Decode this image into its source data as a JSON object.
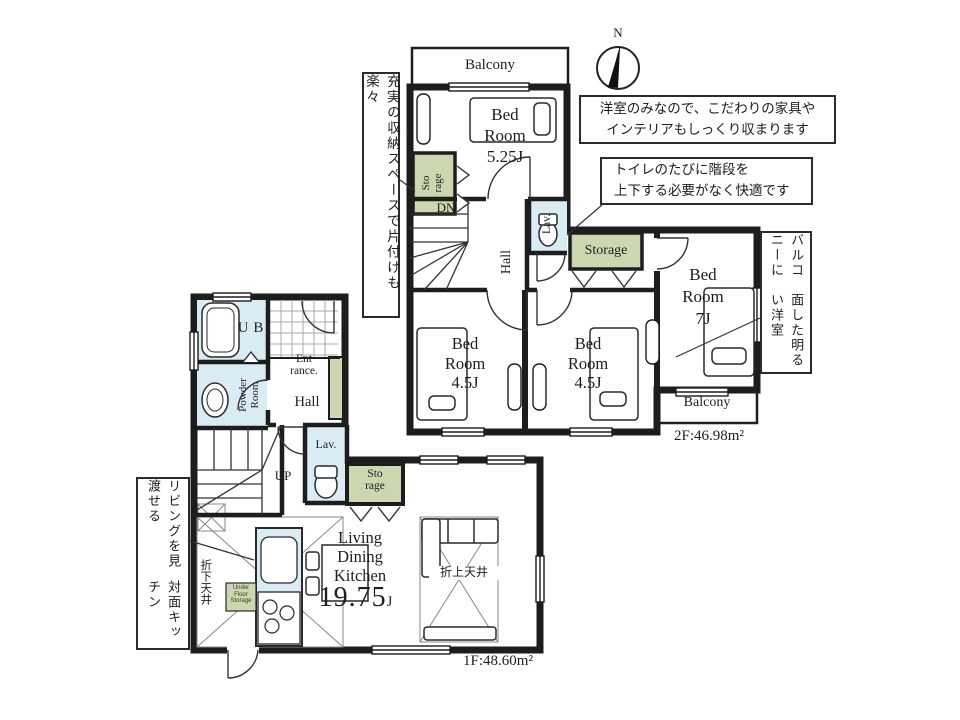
{
  "compass": {
    "north": "N"
  },
  "floor2": {
    "balcony_top": "Balcony",
    "balcony_bottom": "Balcony",
    "bedroom525": {
      "l1": "Bed",
      "l2": "Room",
      "size": "5.25J"
    },
    "bedroom7": {
      "l1": "Bed",
      "l2": "Room",
      "size": "7J"
    },
    "bedroom45_left": {
      "l1": "Bed",
      "l2": "Room",
      "size": "4.5J"
    },
    "bedroom45_right": {
      "l1": "Bed",
      "l2": "Room",
      "size": "4.5J"
    },
    "storage_closet": {
      "l1": "Sto",
      "l2": "rage"
    },
    "storage_hall": "Storage",
    "hall": "Hall",
    "lav": "Lav.",
    "stairs_dn": "DN",
    "area": "2F:46.98m²"
  },
  "floor1": {
    "ub": "UB",
    "powder_room": {
      "l1": "Powder",
      "l2": "Room"
    },
    "entrance": {
      "l1": "Ent",
      "l2": "rance."
    },
    "hall": "Hall",
    "lav": "Lav.",
    "stairs_up": "UP",
    "storage": {
      "l1": "Sto",
      "l2": "rage"
    },
    "ldk": {
      "l1": "Living",
      "l2": "Dining",
      "l3": "Kitchen",
      "size": "19.75",
      "unit": "J"
    },
    "under_floor_storage": {
      "l1": "Under",
      "l2": "Floor",
      "l3": "Storage"
    },
    "raised_ceiling": "折上天井",
    "lowered_ceiling": "折下天井",
    "area": "1F:48.60m²"
  },
  "notes": {
    "storage_vertical": "充実の収納スペースで片付けも楽々",
    "western_l1": "洋室のみなので、こだわりの家具や",
    "western_l2": "インテリアもしっくり収まります",
    "toilet_l1": "トイレのたびに階段を",
    "toilet_l2": "上下する必要がなく快適です",
    "balcony_l1": "バルコニーに",
    "balcony_l2": "面した明るい洋室",
    "kitchen_l1": "リビングを見渡せる",
    "kitchen_l2": "対面キッチン"
  },
  "colors": {
    "wall": "#1d1d1d",
    "storage_green": "#ccd7af",
    "water_blue": "#daecf3"
  }
}
